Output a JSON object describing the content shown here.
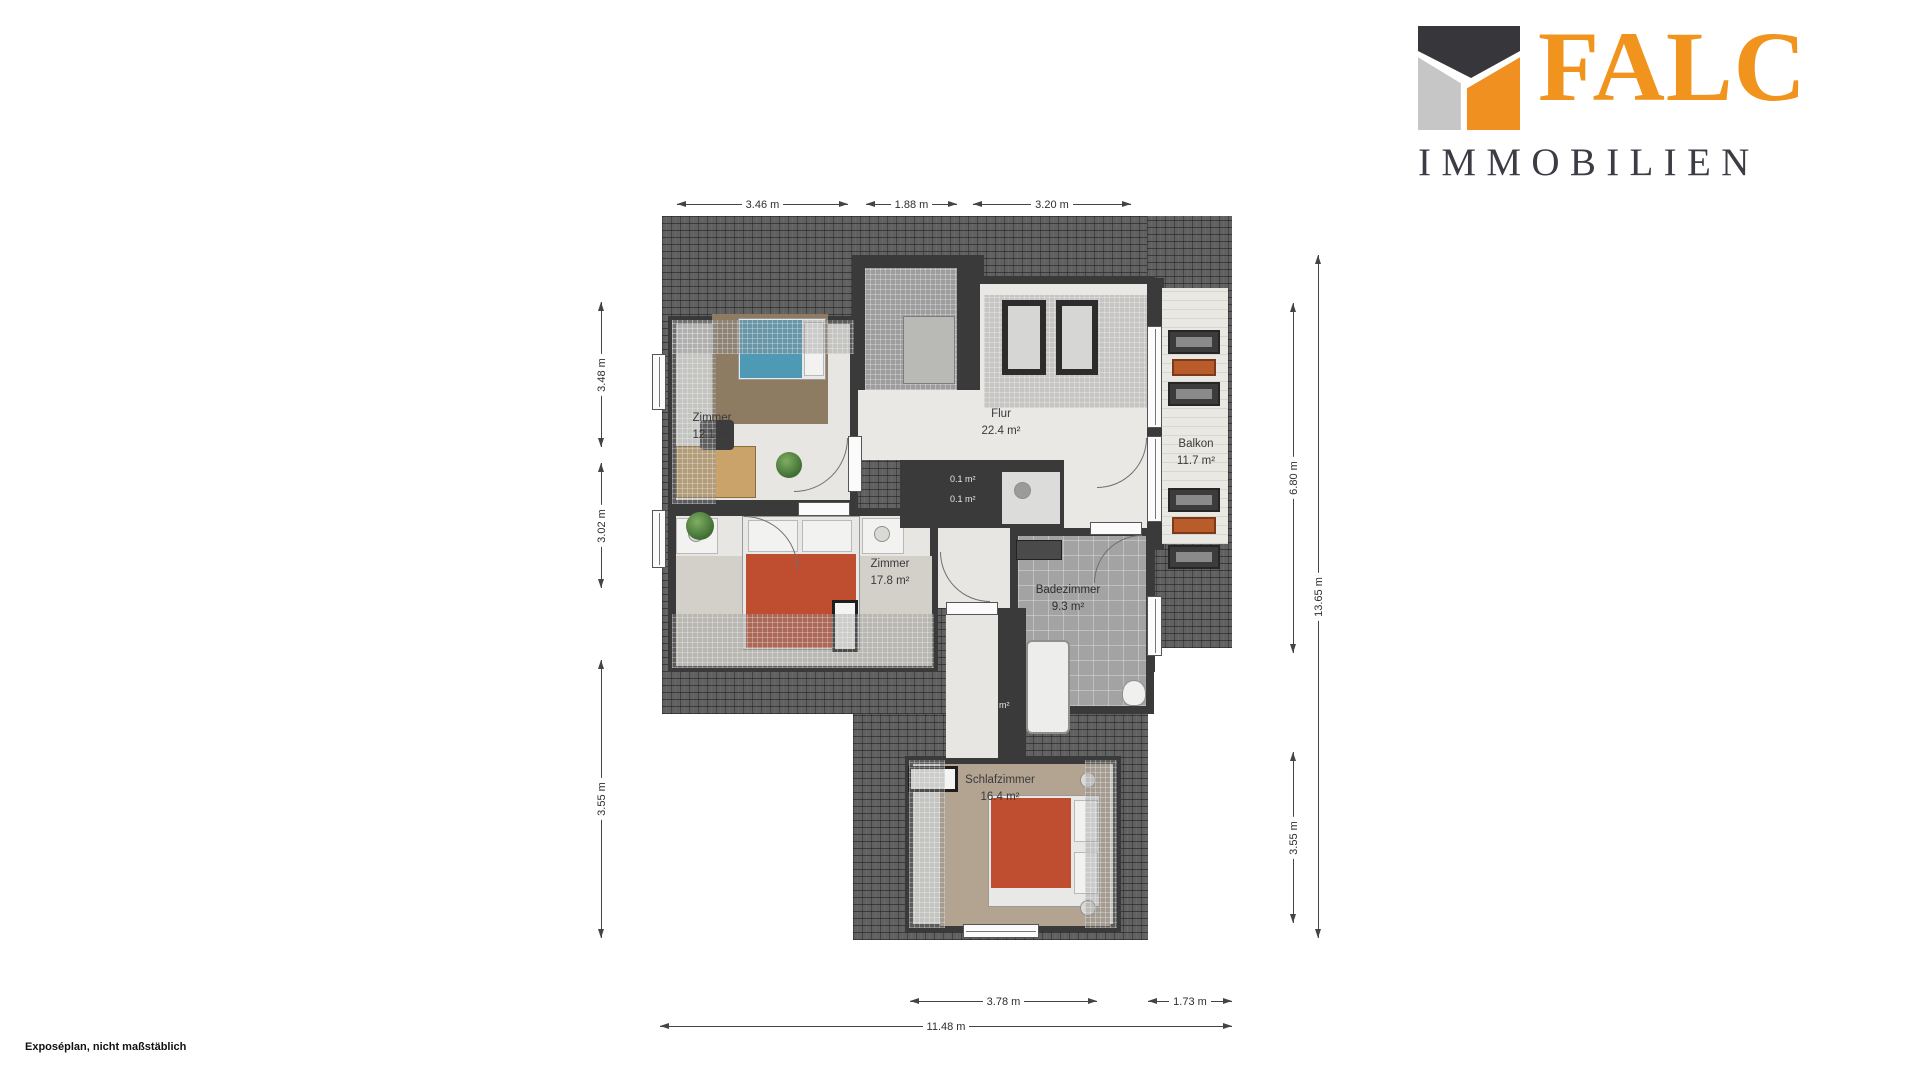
{
  "branding": {
    "logo_text": "FALC",
    "logo_subtext": "IMMOBILIEN",
    "accent_color": "#F0941E",
    "dark_color": "#3C3C44"
  },
  "footer": {
    "note": "Exposéplan, nicht maßstäblich"
  },
  "rooms": {
    "zimmer1": {
      "name": "Zimmer",
      "area": "12.1 m²"
    },
    "flur": {
      "name": "Flur",
      "area": "22.4 m²"
    },
    "balkon": {
      "name": "Balkon",
      "area": "11.7 m²"
    },
    "zimmer2": {
      "name": "Zimmer",
      "area": "17.8 m²"
    },
    "bad": {
      "name": "Badezimmer",
      "area": "9.3 m²"
    },
    "schlafzimmer": {
      "name": "Schlafzimmer",
      "area": "16.4 m²"
    }
  },
  "niches": {
    "a": "0.1 m²",
    "b": "0.1 m²",
    "c": "0.4 m²"
  },
  "dims": {
    "top": [
      "3.46 m",
      "1.88 m",
      "3.20 m"
    ],
    "left": [
      "3.48 m",
      "3.02 m",
      "3.55 m"
    ],
    "right": [
      "6.80 m",
      "13.65 m",
      "3.55 m"
    ],
    "bottom": [
      "3.78 m",
      "1.73 m",
      "11.48 m"
    ]
  }
}
